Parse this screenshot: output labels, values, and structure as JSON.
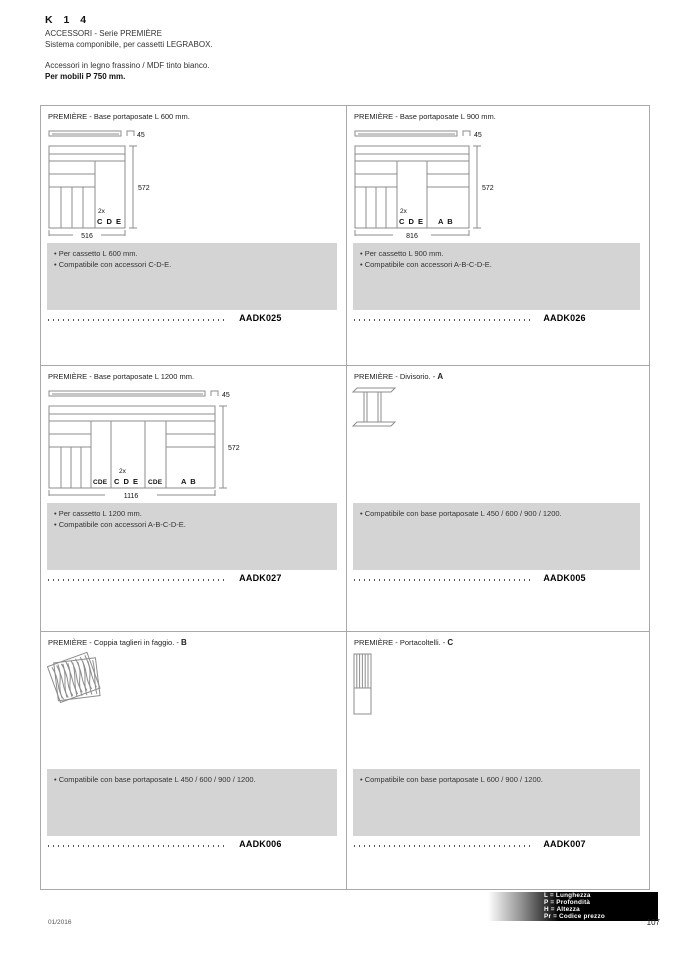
{
  "header": {
    "kicker": "K 1 4",
    "subtitle": "ACCESSORI - Serie PREMIÈRE",
    "line2": "Sistema componibile, per cassetti LEGRABOX.",
    "line3": "Accessori in legno frassino / MDF tinto bianco.",
    "line4": "Per mobili P 750 mm."
  },
  "cells": {
    "c1": {
      "title": "PREMIÈRE - Base portaposate L 600 mm.",
      "letter": "",
      "bullet1": "• Per cassetto L 600 mm.",
      "bullet2": "• Compatibile con accessori C-D-E.",
      "code": "AADK025",
      "dim_top": "45",
      "dim_h": "572",
      "dim_w": "516",
      "qty": "2x",
      "label_cde": "C D E"
    },
    "c2": {
      "title": "PREMIÈRE - Base portaposate L 900 mm.",
      "letter": "",
      "bullet1": "• Per cassetto L 900 mm.",
      "bullet2": "• Compatibile con accessori A-B-C-D-E.",
      "code": "AADK026",
      "dim_top": "45",
      "dim_h": "572",
      "dim_w": "816",
      "qty": "2x",
      "label_cde": "C D E",
      "label_ab": "A B"
    },
    "c3": {
      "title": "PREMIÈRE - Base portaposate L 1200 mm.",
      "letter": "",
      "bullet1": "• Per cassetto L 1200 mm.",
      "bullet2": "• Compatibile con accessori A-B-C-D-E.",
      "code": "AADK027",
      "dim_top": "45",
      "dim_h": "572",
      "dim_w": "1116",
      "qty": "2x",
      "label_cde1": "CDE",
      "label_cde2": "C D E",
      "label_cde3": "CDE",
      "label_ab": "A B"
    },
    "c4": {
      "title": "PREMIÈRE - Divisorio. - ",
      "letter": "A",
      "bullet1": "• Compatibile con base portaposate L 450 / 600 / 900 / 1200.",
      "code": "AADK005"
    },
    "c5": {
      "title": "PREMIÈRE - Coppia taglieri in faggio. - ",
      "letter": "B",
      "bullet1": "• Compatibile con base portaposate L 450 / 600 / 900 / 1200.",
      "code": "AADK006"
    },
    "c6": {
      "title": "PREMIÈRE - Portacoltelli. - ",
      "letter": "C",
      "bullet1": "• Compatibile con base portaposate L 600 / 900 / 1200.",
      "code": "AADK007"
    }
  },
  "footer": {
    "date": "01/2016",
    "page_number": "107",
    "legend1": "L = Lunghezza",
    "legend2": "P = Profondità",
    "legend3": "H = Altezza",
    "legend4": "Pr = Codice prezzo"
  }
}
